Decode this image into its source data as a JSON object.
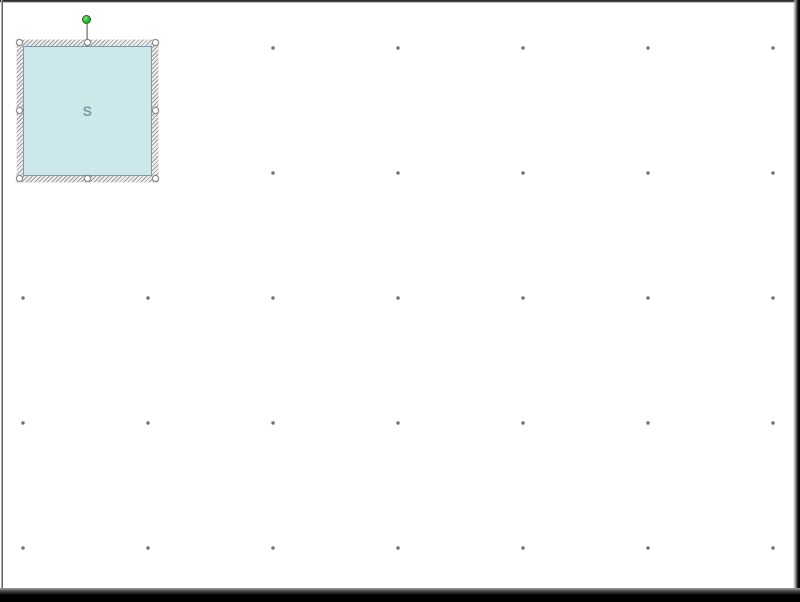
{
  "colors": {
    "canvas-bg": "#ffffff",
    "grid-dot": "#7a7a7a",
    "shape-fill": "#cde8eb",
    "shape-border": "#7d9ba1",
    "shape-text": "#7e99a3",
    "hatch-dark": "#9e9e9e",
    "hatch-light": "#efefef",
    "handle-fill": "#ffffff",
    "handle-border": "#858585",
    "rotation-green": "#2eb82e",
    "rotation-green-border": "#156815"
  },
  "grid": {
    "columns_x": [
      23,
      148,
      273,
      398,
      523,
      648,
      773
    ],
    "rows_y": [
      48,
      173,
      298,
      423,
      548
    ]
  },
  "shape": {
    "label": "S"
  }
}
